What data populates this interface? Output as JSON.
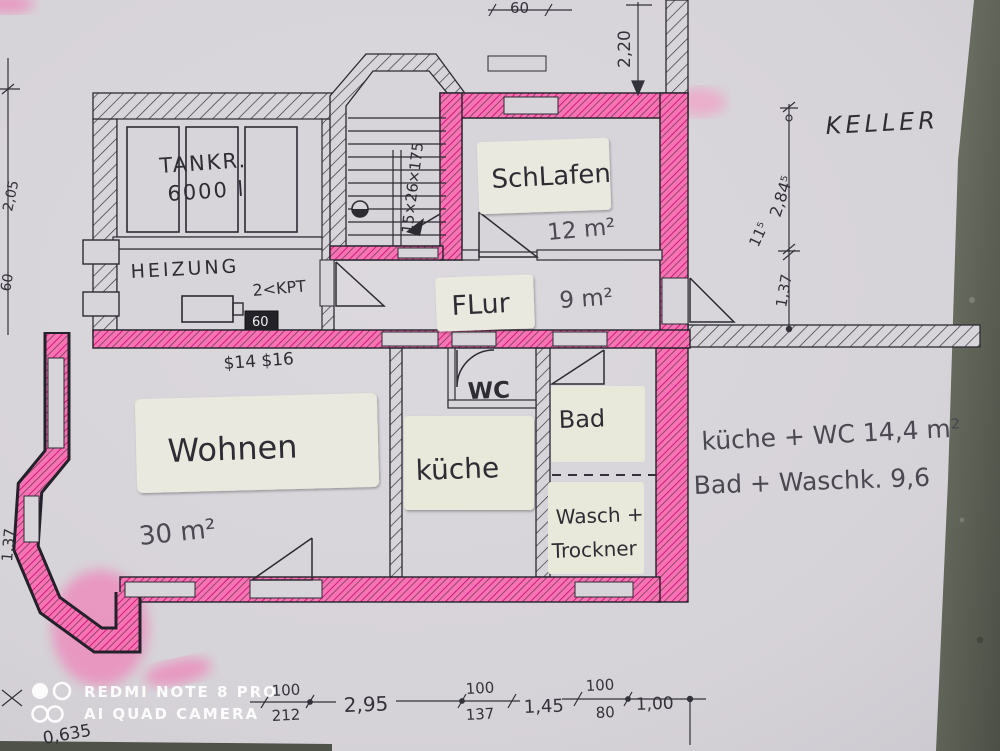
{
  "palette": {
    "paper": "#d8d5da",
    "ink": "#2e2d34",
    "pencil": "#4a4851",
    "highlighter_pink": "#f768ae",
    "highlighter_pink_dark": "#c40e6e",
    "sticker": "#eae9df",
    "stone_edge": "#5d6156",
    "watermark_white": "#ffffff"
  },
  "rooms": {
    "tankraum": {
      "label": "TANKR.",
      "capacity": "6000 l"
    },
    "heizung": {
      "label": "HEIZUNG",
      "note": "2<KPT",
      "meter": "60"
    },
    "schlafen": {
      "label": "SchLafen",
      "area": "12 m²"
    },
    "flur": {
      "label": "FLur",
      "area": "9 m²"
    },
    "wc": {
      "label": "WC"
    },
    "bad": {
      "label": "Bad"
    },
    "kueche": {
      "label": "küche"
    },
    "wasch": {
      "line1": "Wasch +",
      "line2": "Trockner"
    },
    "wohnen": {
      "label": "Wohnen",
      "area": "30 m²"
    },
    "keller": {
      "label": "KELLER"
    }
  },
  "notes": {
    "stairs": "15×26×175",
    "beams": "$14 $16",
    "summary1": "küche + WC 14,4 m²",
    "summary2": "Bad + Waschk. 9,6",
    "corner": "0,635"
  },
  "dims": {
    "top_w": "60",
    "top_h": "2,20",
    "right_a": "2,84⁵",
    "right_b": "11⁵",
    "right_c": "1,37",
    "left_a": "2,05",
    "left_b": "60",
    "left_side": "1,37",
    "bottom": [
      {
        "over": "100",
        "under": "212"
      },
      {
        "single": "2,95"
      },
      {
        "over": "100",
        "under": "137"
      },
      {
        "single": "1,45"
      },
      {
        "over": "100",
        "under": "80"
      },
      {
        "single": "1,00"
      }
    ]
  },
  "watermark": {
    "line1": "REDMI NOTE 8 PRO",
    "line2": "AI QUAD CAMERA"
  }
}
